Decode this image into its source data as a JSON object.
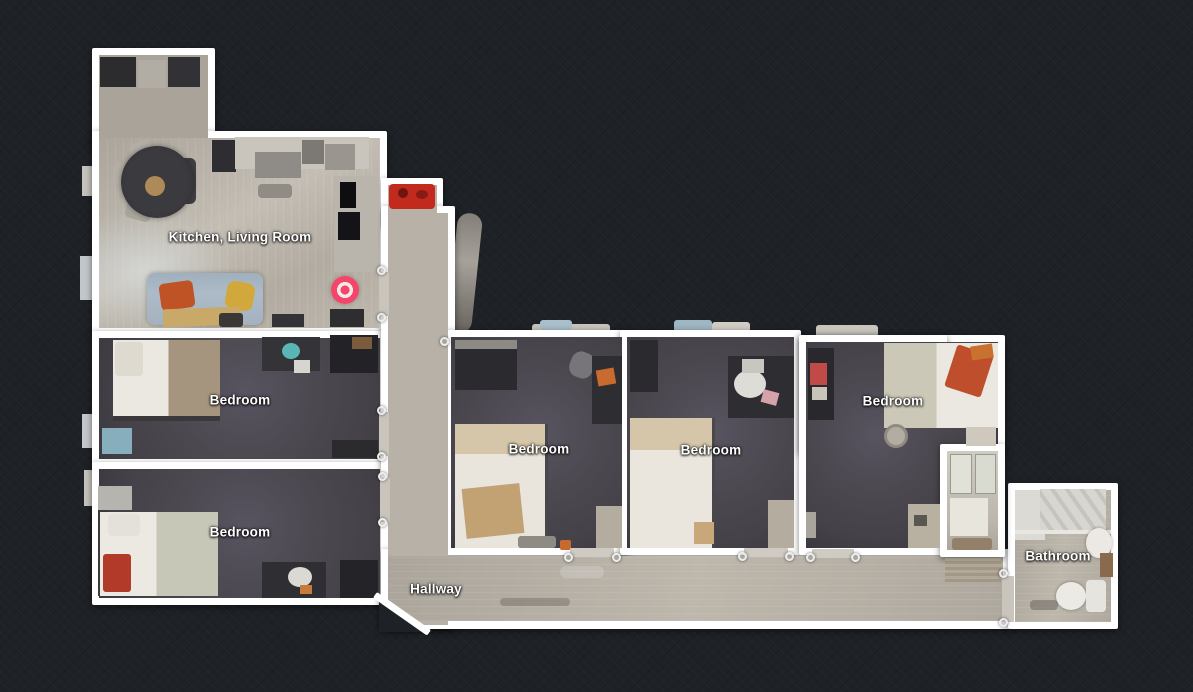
{
  "view": {
    "type": "floorplan-top-down",
    "background": "#1e2126"
  },
  "rooms": [
    {
      "id": "kitchen-living-room",
      "label": "Kitchen, Living Room"
    },
    {
      "id": "bedroom-left-upper",
      "label": "Bedroom"
    },
    {
      "id": "bedroom-left-lower",
      "label": "Bedroom"
    },
    {
      "id": "bedroom-middle-1",
      "label": "Bedroom"
    },
    {
      "id": "bedroom-middle-2",
      "label": "Bedroom"
    },
    {
      "id": "bedroom-right",
      "label": "Bedroom"
    },
    {
      "id": "hallway",
      "label": "Hallway"
    },
    {
      "id": "bathroom",
      "label": "Bathroom"
    }
  ],
  "marker": {
    "id": "camera-position",
    "color": "#f4466b"
  },
  "colors": {
    "background": "#1e2126",
    "wall": "#ffffff",
    "carpet": "#4c4850",
    "wood_floor": "#b7b1a7",
    "marker_pink": "#f4466b"
  }
}
